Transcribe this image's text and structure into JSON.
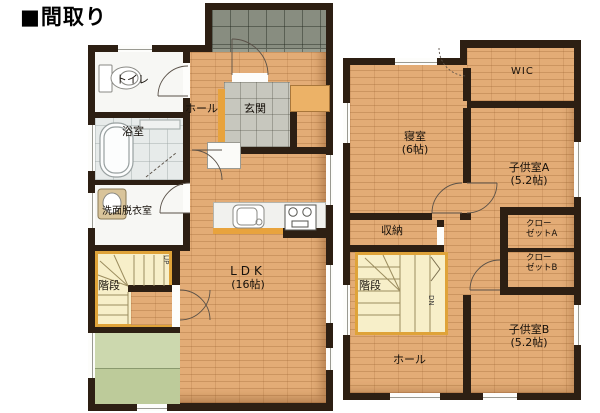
{
  "title": "■間取り",
  "colors": {
    "wall": "#2d1f13",
    "wood": "#e3ac76",
    "tile_genkan": "#c7c7be",
    "tile_porch": "#989d8f",
    "tatami": "#ccd8ae",
    "tatami_dark": "#bdcb9a",
    "stairs_fill": "#f7efc9",
    "stairs_frame": "#dfa339",
    "accent_orange": "#e8a33d",
    "fixture_white": "#f7f7f4",
    "bath_floor": "#e7ebea",
    "cabinet": "#ecb267"
  },
  "floor1": {
    "toilet": "トイレ",
    "bath": "浴室",
    "washroom": "洗面脱衣室",
    "hall": "ホール",
    "entrance": "玄関",
    "stairs": "階段",
    "up": "UP",
    "ldk": "LDK",
    "ldk_size": "(16帖)"
  },
  "floor2": {
    "wic": "WIC",
    "bedroom": "寝室",
    "bedroom_size": "(6帖)",
    "kids_a": "子供室A",
    "kids_a_size": "(5.2帖)",
    "storage": "収納",
    "closet_a_line1": "クロー",
    "closet_a_line2": "ゼットA",
    "closet_b_line1": "クロー",
    "closet_b_line2": "ゼットB",
    "stairs": "階段",
    "dn": "DN",
    "hall": "ホール",
    "kids_b": "子供室B",
    "kids_b_size": "(5.2帖)"
  }
}
